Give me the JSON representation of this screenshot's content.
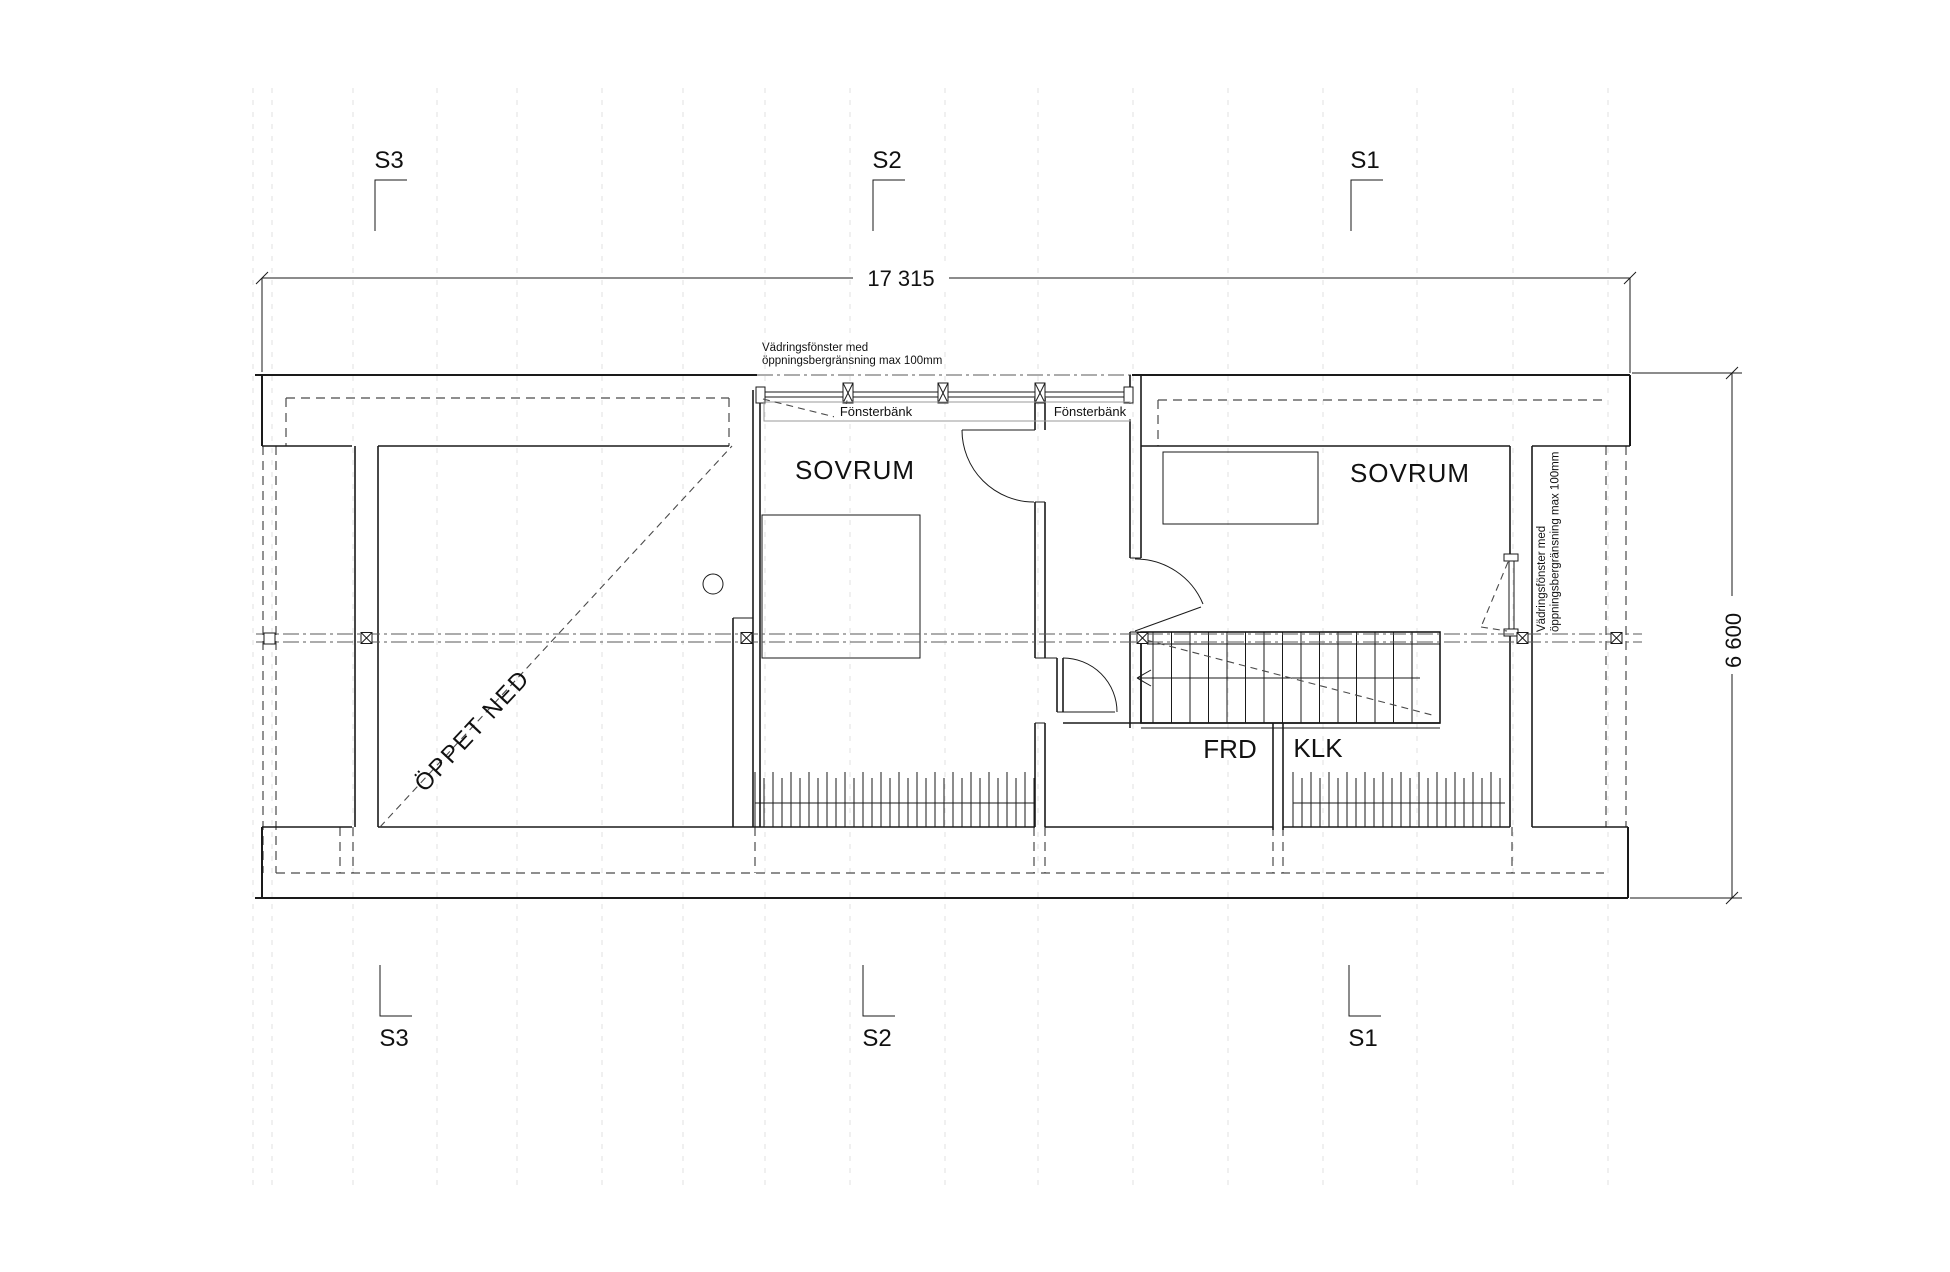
{
  "plan": {
    "type": "floor-plan",
    "dimensions": {
      "width": "17 315",
      "depth": "6 600"
    },
    "section_markers": [
      {
        "id": "S3"
      },
      {
        "id": "S2"
      },
      {
        "id": "S1"
      }
    ],
    "rooms": {
      "bedroom_mid": "SOVRUM",
      "bedroom_right": "SOVRUM",
      "open_to_below": "ÖPPET NED",
      "storage": "FRD",
      "walk_in_closet": "KLK"
    },
    "labels": {
      "window_sill": "Fönsterbänk"
    },
    "notes": {
      "vent_window": {
        "line1": "Vädringsfönster med",
        "line2": "öppningsbergränsning max 100mm"
      }
    },
    "symbols": {
      "column_marker": "x-square-icon",
      "grid_node": "square-icon",
      "stair_direction": "arrow-left-icon"
    },
    "colors": {
      "line": "#1a1a1a",
      "grid": "#e0e0e0",
      "roof_dash": "#4a4a4a",
      "centerline": "#5a5a5a",
      "sill_outline": "#9a9a9a"
    }
  }
}
